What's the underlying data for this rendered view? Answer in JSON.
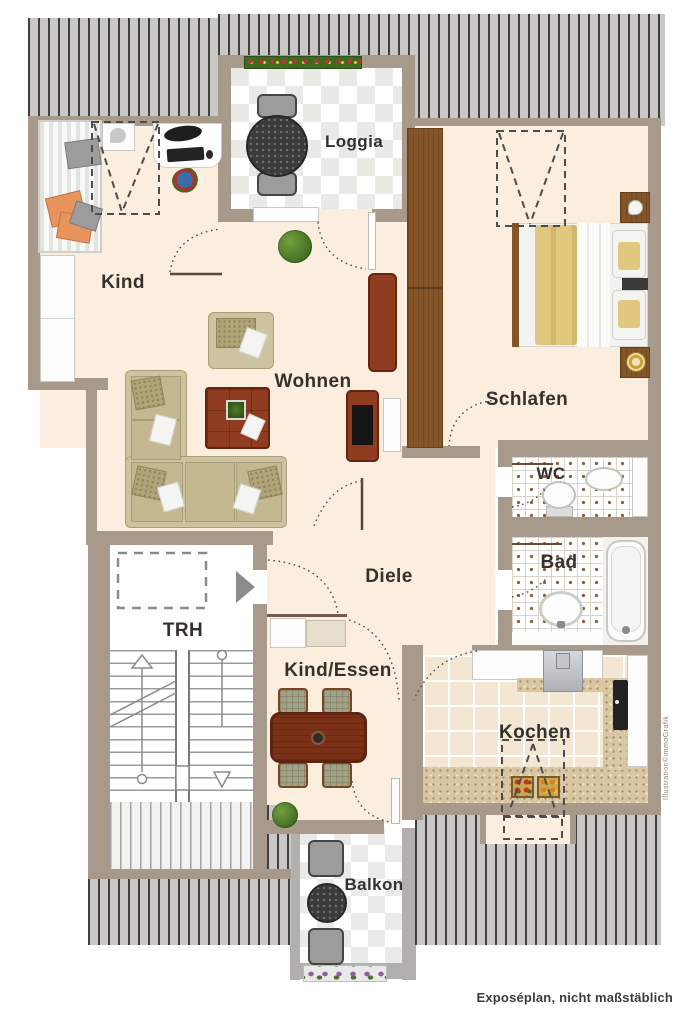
{
  "document": {
    "type": "floor-plan",
    "footer": "Exposéplan, nicht maßstäblich",
    "watermark": "Illustration©immoGrafik"
  },
  "rooms": [
    {
      "id": "loggia",
      "label": "Loggia"
    },
    {
      "id": "kind",
      "label": "Kind"
    },
    {
      "id": "wohnen",
      "label": "Wohnen"
    },
    {
      "id": "schlafen",
      "label": "Schlafen"
    },
    {
      "id": "wc",
      "label": "WC"
    },
    {
      "id": "bad",
      "label": "Bad"
    },
    {
      "id": "diele",
      "label": "Diele"
    },
    {
      "id": "trh",
      "label": "TRH"
    },
    {
      "id": "kind_essen",
      "label": "Kind/Essen"
    },
    {
      "id": "kochen",
      "label": "Kochen"
    },
    {
      "id": "balkon",
      "label": "Balkon"
    }
  ],
  "colors": {
    "wall": "#a79a8b",
    "floor_cream": "#fbeede",
    "roof_hatch_bg": "#c9c8c6",
    "roof_hatch_line": "#3f3f3d",
    "bath_tile_dot": "#8a5d3b",
    "wood_furniture": "#855527",
    "red_furniture": "#8f3c20",
    "balcony_wall": "#b2b0ad",
    "label_text": "#34302c"
  }
}
